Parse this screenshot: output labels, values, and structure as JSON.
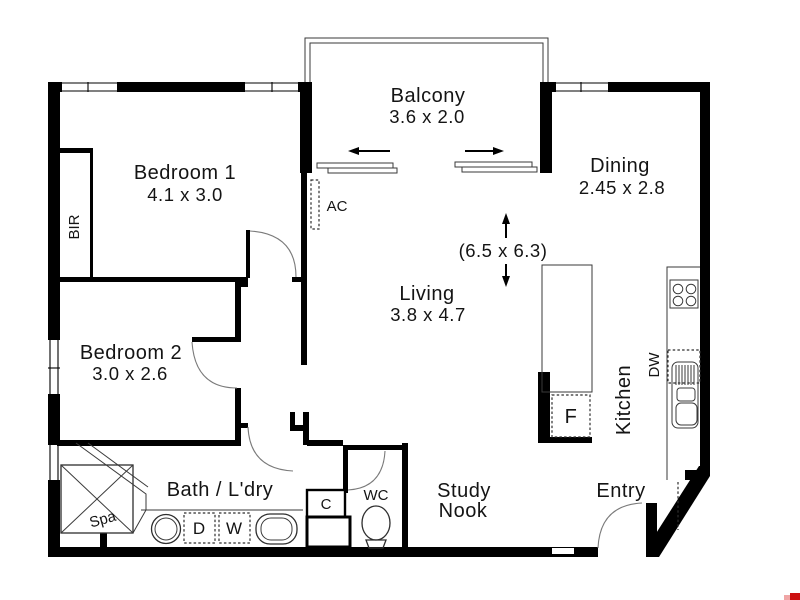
{
  "plan": {
    "title": "Apartment floor plan",
    "rooms": {
      "balcony": {
        "name": "Balcony",
        "dims": "3.6 x 2.0"
      },
      "bedroom1": {
        "name": "Bedroom 1",
        "dims": "4.1 x 3.0"
      },
      "dining": {
        "name": "Dining",
        "dims": "2.45 x 2.8"
      },
      "living": {
        "name": "Living",
        "dims": "3.8 x 4.7"
      },
      "bedroom2": {
        "name": "Bedroom 2",
        "dims": "3.0 x 2.6"
      },
      "bath": {
        "name": "Bath / L'dry"
      },
      "kitchen": {
        "name": "Kitchen"
      },
      "study_nook": {
        "line1": "Study",
        "line2": "Nook"
      },
      "entry": {
        "name": "Entry"
      },
      "wc": {
        "name": "WC"
      }
    },
    "overall_dims": "(6.5 x 6.3)",
    "fixtures": {
      "bir": "BIR",
      "ac": "AC",
      "spa": "Spa",
      "dryer": "D",
      "washer": "W",
      "cupboard": "C",
      "fridge": "F",
      "dishwasher": "DW"
    },
    "colors": {
      "wall": "#000000",
      "background": "#ffffff",
      "fixture_line": "#2e2e2e",
      "door_arc": "#7a7a7a",
      "watermark_red": "#cc1010",
      "watermark_pink": "#f0a6a6"
    }
  }
}
